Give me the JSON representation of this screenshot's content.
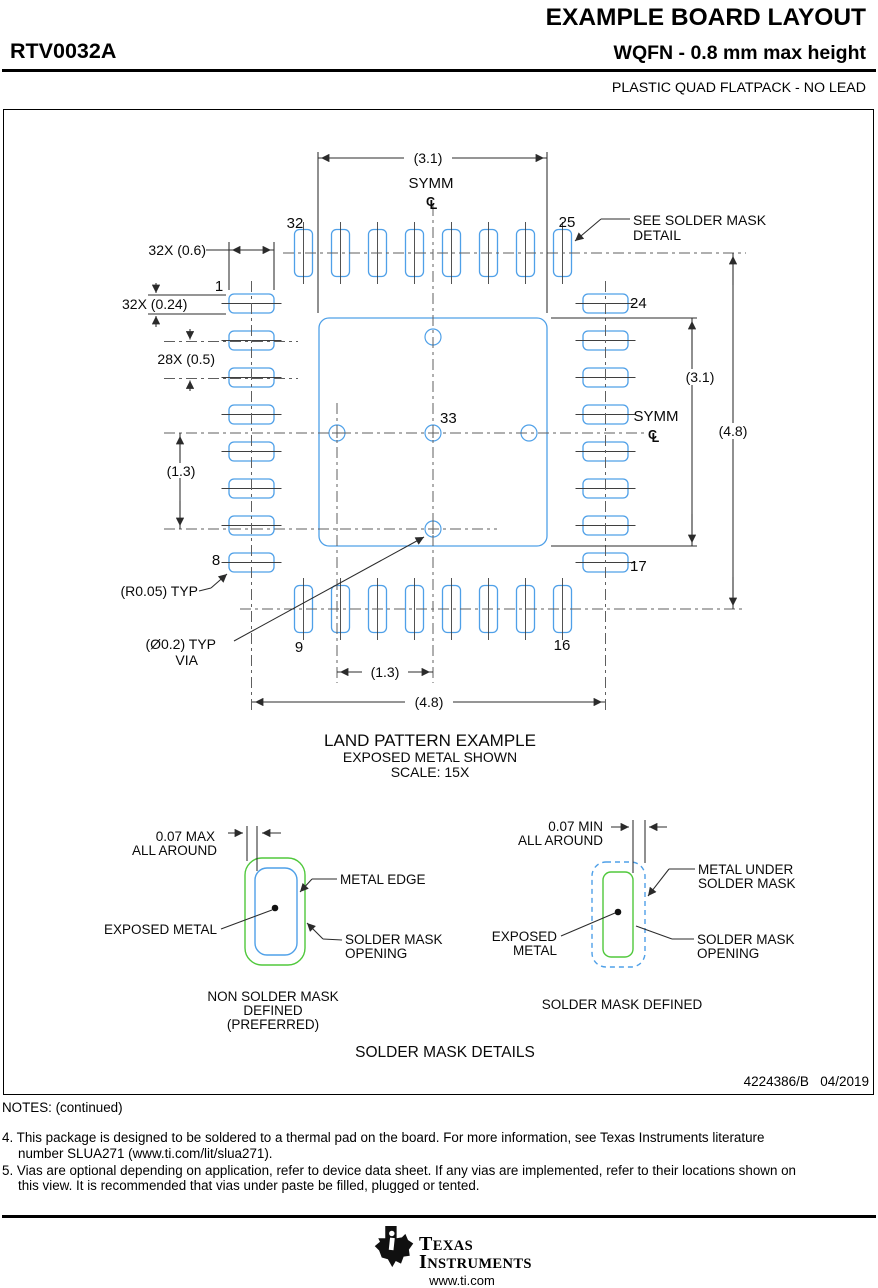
{
  "header": {
    "doc_title": "EXAMPLE BOARD LAYOUT",
    "part_number": "RTV0032A",
    "package_title": "WQFN - 0.8 mm max height",
    "package_subtitle": "PLASTIC QUAD FLATPACK - NO LEAD"
  },
  "land_pattern": {
    "caption_line1": "LAND PATTERN EXAMPLE",
    "caption_line2": "EXPOSED METAL SHOWN",
    "caption_line3": "SCALE: 15X",
    "dims": {
      "d31": "(3.1)",
      "d48": "(4.8)",
      "d13": "(1.3)",
      "pad_length": "32X (0.6)",
      "pad_width": "32X (0.24)",
      "pad_pitch": "28X (0.5)",
      "corner_radius": "(R0.05) TYP",
      "via_dia": "(Ø0.2) TYP",
      "via_word": "VIA"
    },
    "labels": {
      "symm": "SYMM",
      "cl_c": "C",
      "cl_l": "L",
      "see_mask_1": "SEE SOLDER MASK",
      "see_mask_2": "DETAIL",
      "thermal_pad_pin": "33"
    },
    "pins": {
      "p1": "1",
      "p8": "8",
      "p9": "9",
      "p16": "16",
      "p17": "17",
      "p24": "24",
      "p25": "25",
      "p32": "32"
    }
  },
  "solder_mask": {
    "left": {
      "dim_line1": "0.07 MAX",
      "dim_line2": "ALL AROUND",
      "metal_edge": "METAL EDGE",
      "exposed_metal": "EXPOSED METAL",
      "opening_line1": "SOLDER MASK",
      "opening_line2": "OPENING",
      "caption_line1": "NON SOLDER MASK",
      "caption_line2": "DEFINED",
      "caption_line3": "(PREFERRED)"
    },
    "right": {
      "dim_line1": "0.07 MIN",
      "dim_line2": "ALL AROUND",
      "metal_line1": "METAL UNDER",
      "metal_line2": "SOLDER MASK",
      "exposed_line1": "EXPOSED",
      "exposed_line2": "METAL",
      "opening_line1": "SOLDER MASK",
      "opening_line2": "OPENING",
      "caption": "SOLDER MASK DEFINED"
    },
    "section_title": "SOLDER MASK DETAILS"
  },
  "revision": "4224386/B   04/2019",
  "notes": {
    "heading": "NOTES: (continued)",
    "items": [
      "4. This package is designed to be soldered to a thermal pad on the board. For more information, see Texas Instruments literature number SLUA271 (www.ti.com/lit/slua271).",
      "5. Vias are optional depending on application, refer to device data sheet. If any vias are implemented, refer to their locations shown on this view. It is recommended that vias under paste be filled, plugged or tented."
    ]
  },
  "footer": {
    "brand_line1": "TEXAS",
    "brand_line2": "INSTRUMENTS",
    "website": "www.ti.com"
  },
  "colors": {
    "pad_blue": "#4FA0E8",
    "mask_green": "#50C83C",
    "line_dark": "#2b2b2b"
  }
}
